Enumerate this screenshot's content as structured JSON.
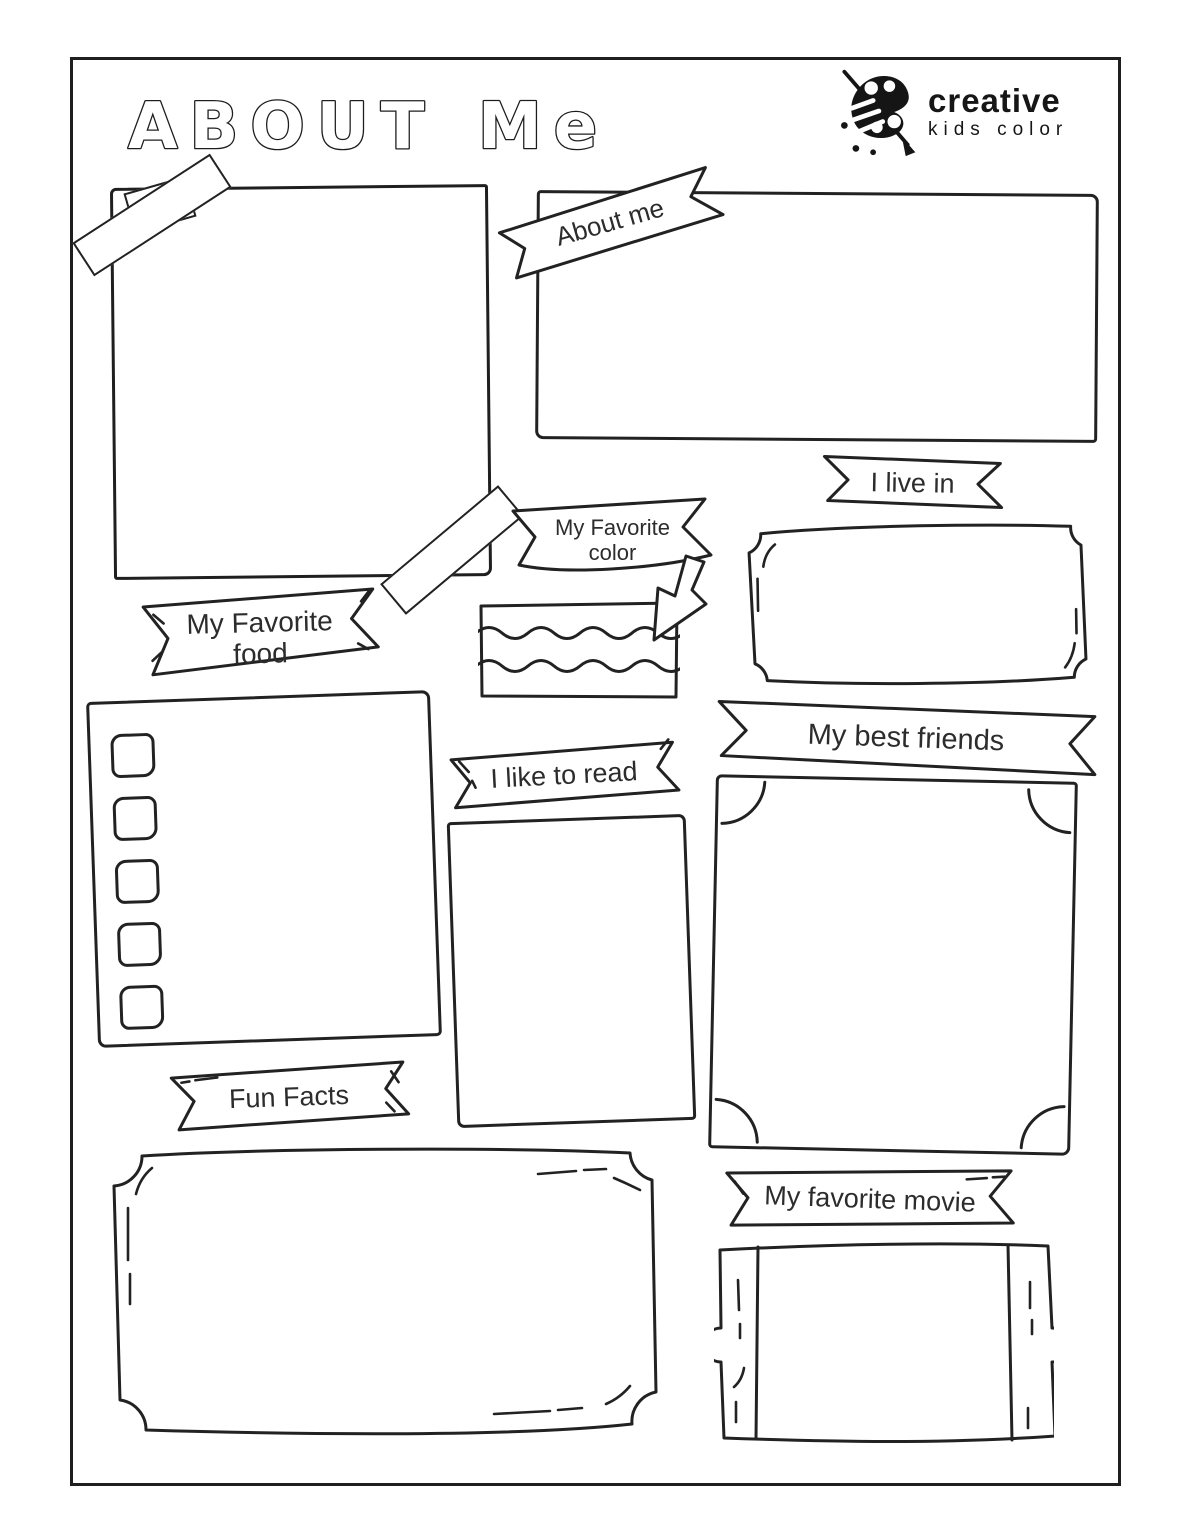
{
  "page": {
    "background": "#ffffff",
    "ink": "#1f1f1f",
    "title_word1": "ABOUT",
    "title_word2": "Me"
  },
  "logo": {
    "icon": "paint-palette-with-brush-icon",
    "line1": "creative",
    "line2": "kids color"
  },
  "sections": {
    "about_me": {
      "label": "About me"
    },
    "live_in": {
      "label": "I live in"
    },
    "favorite_color": {
      "line1": "My Favorite",
      "line2": "color"
    },
    "favorite_food": {
      "line1": "My Favorite",
      "line2": "food"
    },
    "like_to_read": {
      "label": "I like to read"
    },
    "best_friends": {
      "label": "My best friends"
    },
    "fun_facts": {
      "label": "Fun Facts"
    },
    "favorite_movie": {
      "label": "My favorite movie"
    }
  }
}
